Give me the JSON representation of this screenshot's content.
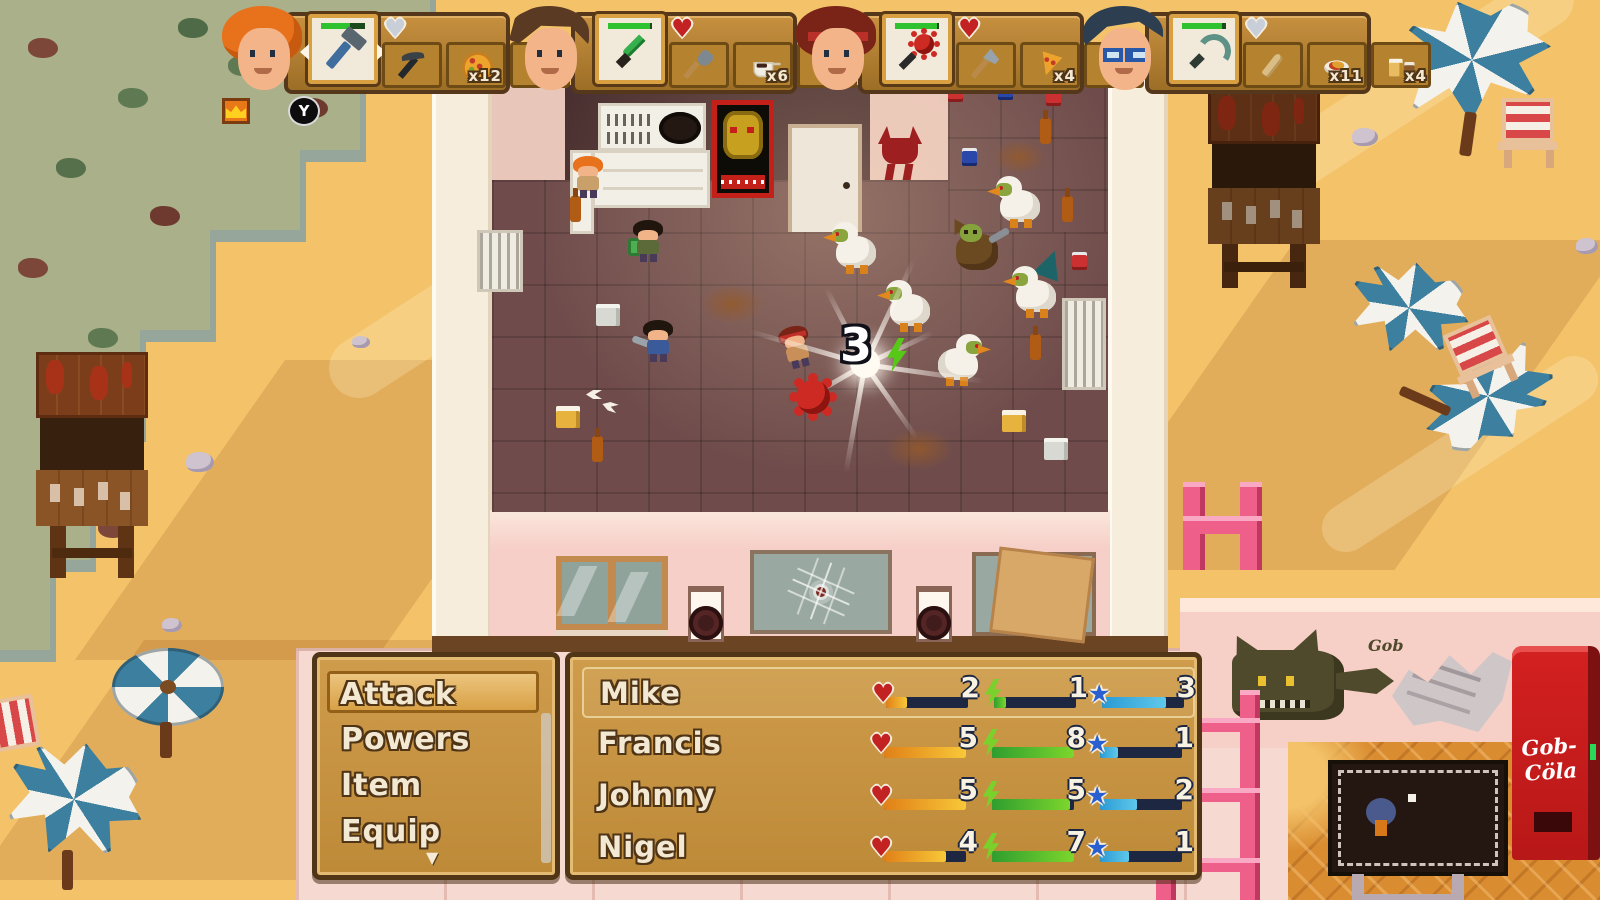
{
  "hud": {
    "button_prompt": "Y",
    "players": [
      {
        "portrait": "orange-hair",
        "crown": true,
        "hearts": {
          "filled": 2,
          "total": 5
        },
        "weapon": {
          "icon": "hammer",
          "durability": 65
        },
        "items": [
          {
            "icon": "pickaxe",
            "count": ""
          },
          {
            "icon": "pizza",
            "count": "x12"
          },
          {
            "icon": "glue",
            "count": "x6"
          }
        ]
      },
      {
        "portrait": "brunette",
        "hearts": {
          "filled": 5,
          "total": 5
        },
        "weapon": {
          "icon": "green-knife",
          "durability": 95
        },
        "items": [
          {
            "icon": "shovel",
            "count": ""
          },
          {
            "icon": "coffee",
            "count": "x6"
          },
          {
            "icon": "soda",
            "count": "x3"
          }
        ]
      },
      {
        "portrait": "red-bandana",
        "hearts": {
          "filled": 5,
          "total": 5
        },
        "weapon": {
          "icon": "mace",
          "durability": 95
        },
        "items": [
          {
            "icon": "axe",
            "count": ""
          },
          {
            "icon": "pizza-slice",
            "count": "x4"
          },
          {
            "icon": "ketchup",
            "count": "x4"
          }
        ]
      },
      {
        "portrait": "glasses",
        "hearts": {
          "filled": 4,
          "total": 5
        },
        "weapon": {
          "icon": "hook",
          "durability": 90
        },
        "items": [
          {
            "icon": "club",
            "count": ""
          },
          {
            "icon": "spaghetti",
            "count": "x11"
          },
          {
            "icon": "beer",
            "count": "x4"
          }
        ]
      }
    ]
  },
  "battle": {
    "damage_number": "3"
  },
  "menu": {
    "items": [
      {
        "label": "Attack",
        "selected": true
      },
      {
        "label": "Powers"
      },
      {
        "label": "Item"
      },
      {
        "label": "Equip"
      }
    ],
    "more_indicator": "▼"
  },
  "party": {
    "rows": [
      {
        "name": "Mike",
        "selected": true,
        "hp": {
          "value": "2",
          "fill": 25
        },
        "power": {
          "value": "1",
          "fill": 15
        },
        "stars": {
          "value": "3",
          "fill": 78
        }
      },
      {
        "name": "Francis",
        "hp": {
          "value": "5",
          "fill": 100
        },
        "power": {
          "value": "8",
          "fill": 100
        },
        "stars": {
          "value": "1",
          "fill": 22
        }
      },
      {
        "name": "Johnny",
        "hp": {
          "value": "5",
          "fill": 100
        },
        "power": {
          "value": "5",
          "fill": 95
        },
        "stars": {
          "value": "2",
          "fill": 45
        }
      },
      {
        "name": "Nigel",
        "hp": {
          "value": "4",
          "fill": 75
        },
        "power": {
          "value": "7",
          "fill": 100
        },
        "stars": {
          "value": "1",
          "fill": 35
        }
      }
    ]
  },
  "world": {
    "graffiti_text": "Gob",
    "cola_machine": {
      "line1": "Gob-",
      "line2": "Cöla"
    }
  },
  "colors": {
    "accent_pink": "#ee5f8a",
    "cola_red": "#c81c1c",
    "hud_brown": "#9c6e26",
    "hp_bar": "#f8c838",
    "power_bar": "#7cd62c",
    "star_bar": "#5fc8ea"
  }
}
